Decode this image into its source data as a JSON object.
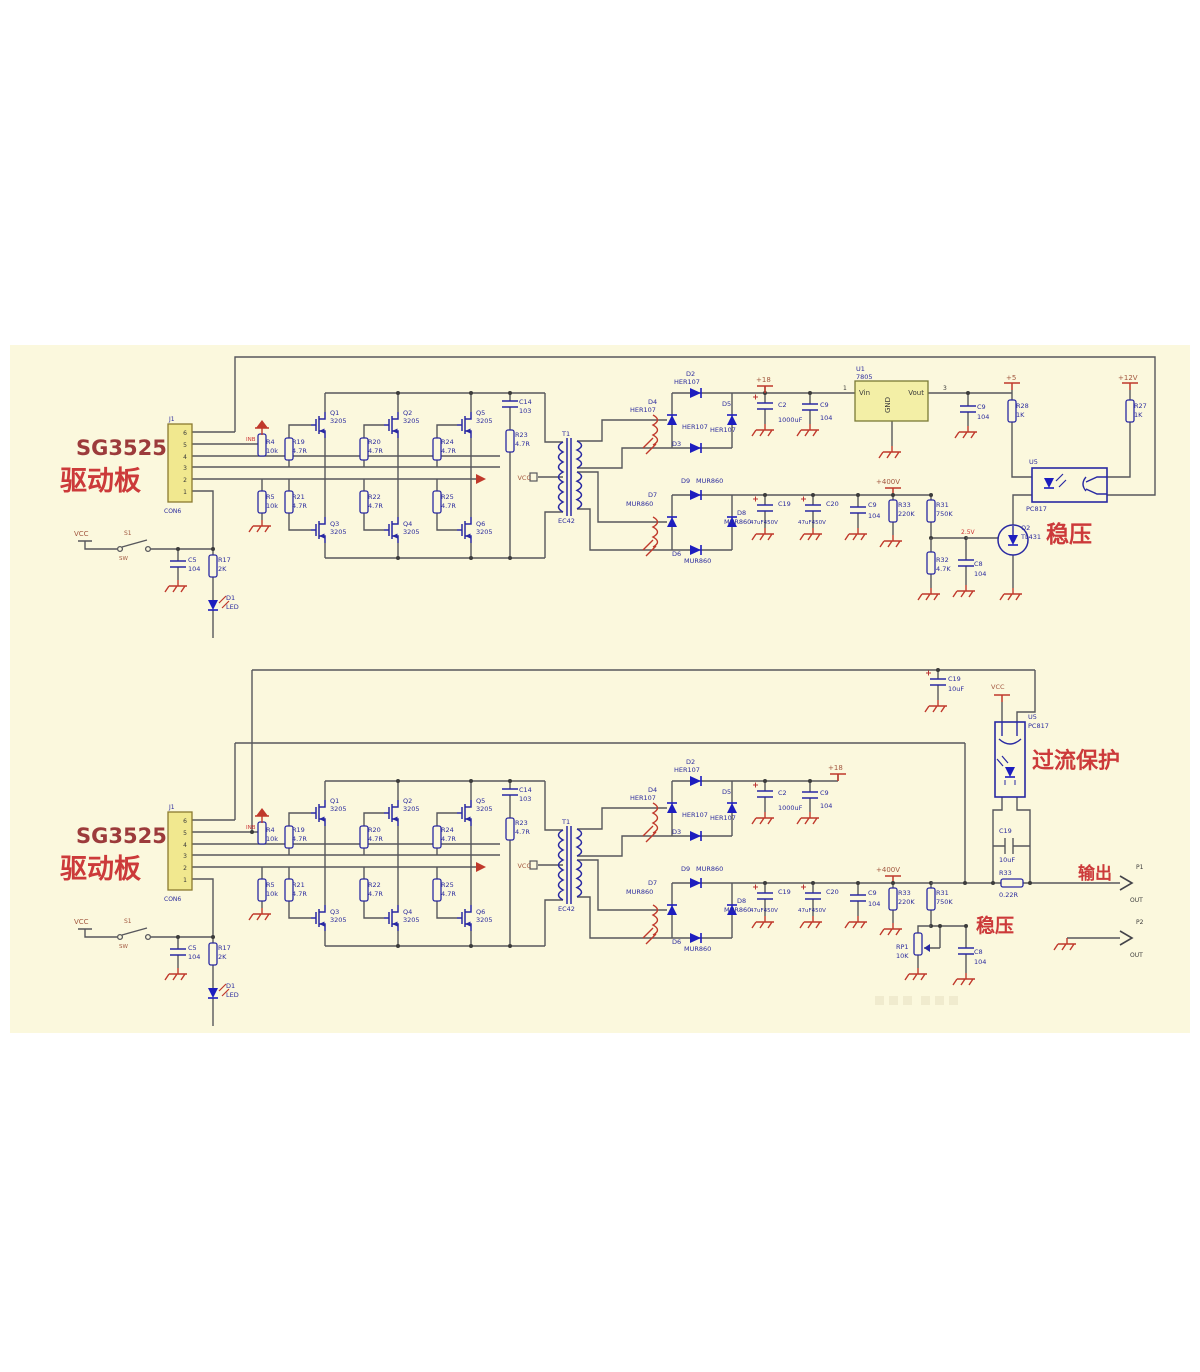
{
  "canvas": {
    "width": 1200,
    "height": 1372,
    "background": "#ffffff",
    "paper_color": "#fbf8dd",
    "paper_area": {
      "x": 10,
      "y": 345,
      "w": 1180,
      "h": 688
    }
  },
  "colors": {
    "wire": "#57575c",
    "component_blue": "#2929a3",
    "diode_fill": "#1d1dbf",
    "power_red": "#c0392b",
    "connector_yellow": "#f1e88f",
    "regulator_yellow": "#f3efa6",
    "label_blue": "#2b2b9e",
    "label_power": "#a2573f",
    "annotation_red": "#cc3a3a"
  },
  "text_styles": {
    "b": {
      "fill": "#2b2b9e",
      "size": 6.5
    },
    "p": {
      "fill": "#a2573f",
      "size": 7
    },
    "r": {
      "fill": "#cc3333",
      "size": 6
    },
    "k": {
      "fill": "#3a3a3a",
      "size": 6.5
    },
    "t1": {
      "fill": "#9c3b3b",
      "size": 21,
      "weight": "bold",
      "family": "Liberation Serif, serif"
    },
    "t2": {
      "fill": "#cc3a3a",
      "size": 27,
      "weight": "bold"
    },
    "a": {
      "fill": "#cc3a3a",
      "size": 21,
      "weight": "bold"
    }
  },
  "texts": [
    {
      "n": "board-title",
      "t": "SG3525",
      "x": 76,
      "y": 455,
      "c": "t1",
      "d": 1
    },
    {
      "n": "board-title-cn",
      "t": "驱动板",
      "x": 60,
      "y": 490,
      "c": "t2",
      "d": 1
    },
    {
      "n": "component-label",
      "t": "J1",
      "x": 169,
      "y": 421,
      "s": 6,
      "d": 1
    },
    {
      "n": "component-label",
      "t": "CON6",
      "x": 164,
      "y": 513,
      "s": 6,
      "d": 1
    },
    {
      "n": "pin-number",
      "t": "6",
      "x": 187,
      "y": 435,
      "c": "k",
      "s": 6,
      "a": "e",
      "d": 1
    },
    {
      "n": "pin-number",
      "t": "5",
      "x": 187,
      "y": 447,
      "c": "k",
      "s": 6,
      "a": "e",
      "d": 1
    },
    {
      "n": "pin-number",
      "t": "4",
      "x": 187,
      "y": 459,
      "c": "k",
      "s": 6,
      "a": "e",
      "d": 1
    },
    {
      "n": "pin-number",
      "t": "3",
      "x": 187,
      "y": 470,
      "c": "k",
      "s": 6,
      "a": "e",
      "d": 1
    },
    {
      "n": "pin-number",
      "t": "2",
      "x": 187,
      "y": 482,
      "c": "k",
      "s": 6,
      "a": "e",
      "d": 1
    },
    {
      "n": "pin-number",
      "t": "1",
      "x": 187,
      "y": 494,
      "c": "k",
      "s": 6,
      "a": "e",
      "d": 1
    },
    {
      "n": "net-label",
      "t": "INB",
      "x": 246,
      "y": 441,
      "c": "r",
      "s": 5.5,
      "d": 1
    },
    {
      "n": "net-label",
      "t": "VCC",
      "x": 74,
      "y": 536,
      "c": "p",
      "d": 1
    },
    {
      "n": "component-label",
      "t": "S1",
      "x": 124,
      "y": 535,
      "c": "p",
      "s": 6,
      "d": 1
    },
    {
      "n": "component-label",
      "t": "SW",
      "x": 119,
      "y": 560,
      "c": "p",
      "s": 5.5,
      "d": 1
    },
    {
      "n": "component-label",
      "t": "C5",
      "x": 188,
      "y": 562,
      "d": 1
    },
    {
      "n": "component-label",
      "t": "104",
      "x": 188,
      "y": 571,
      "d": 1
    },
    {
      "n": "component-label",
      "t": "R17",
      "x": 218,
      "y": 562,
      "d": 1
    },
    {
      "n": "component-label",
      "t": "2K",
      "x": 218,
      "y": 571,
      "d": 1
    },
    {
      "n": "component-label",
      "t": "D1",
      "x": 226,
      "y": 600,
      "d": 1
    },
    {
      "n": "component-label",
      "t": "LED",
      "x": 226,
      "y": 609,
      "d": 1
    },
    {
      "n": "component-label",
      "t": "R4",
      "x": 266,
      "y": 444,
      "d": 1
    },
    {
      "n": "component-label",
      "t": "10k",
      "x": 266,
      "y": 453,
      "d": 1
    },
    {
      "n": "component-label",
      "t": "R19",
      "x": 292,
      "y": 444,
      "d": 1
    },
    {
      "n": "component-label",
      "t": "4.7R",
      "x": 292,
      "y": 453,
      "d": 1
    },
    {
      "n": "component-label",
      "t": "R5",
      "x": 266,
      "y": 499,
      "d": 1
    },
    {
      "n": "component-label",
      "t": "10k",
      "x": 266,
      "y": 508,
      "d": 1
    },
    {
      "n": "component-label",
      "t": "R21",
      "x": 292,
      "y": 499,
      "d": 1
    },
    {
      "n": "component-label",
      "t": "4.7R",
      "x": 292,
      "y": 508,
      "d": 1
    },
    {
      "n": "component-label",
      "t": "Q1",
      "x": 330,
      "y": 415,
      "d": 1
    },
    {
      "n": "component-label",
      "t": "3205",
      "x": 330,
      "y": 423,
      "d": 1
    },
    {
      "n": "component-label",
      "t": "Q2",
      "x": 403,
      "y": 415,
      "d": 1
    },
    {
      "n": "component-label",
      "t": "3205",
      "x": 403,
      "y": 423,
      "d": 1
    },
    {
      "n": "component-label",
      "t": "Q5",
      "x": 476,
      "y": 415,
      "d": 1
    },
    {
      "n": "component-label",
      "t": "3205",
      "x": 476,
      "y": 423,
      "d": 1
    },
    {
      "n": "component-label",
      "t": "R20",
      "x": 368,
      "y": 444,
      "d": 1
    },
    {
      "n": "component-label",
      "t": "4.7R",
      "x": 368,
      "y": 453,
      "d": 1
    },
    {
      "n": "component-label",
      "t": "R24",
      "x": 441,
      "y": 444,
      "d": 1
    },
    {
      "n": "component-label",
      "t": "4.7R",
      "x": 441,
      "y": 453,
      "d": 1
    },
    {
      "n": "component-label",
      "t": "R22",
      "x": 368,
      "y": 499,
      "d": 1
    },
    {
      "n": "component-label",
      "t": "4.7R",
      "x": 368,
      "y": 508,
      "d": 1
    },
    {
      "n": "component-label",
      "t": "R25",
      "x": 441,
      "y": 499,
      "d": 1
    },
    {
      "n": "component-label",
      "t": "4.7R",
      "x": 441,
      "y": 508,
      "d": 1
    },
    {
      "n": "component-label",
      "t": "Q3",
      "x": 330,
      "y": 526,
      "d": 1
    },
    {
      "n": "component-label",
      "t": "3205",
      "x": 330,
      "y": 534,
      "d": 1
    },
    {
      "n": "component-label",
      "t": "Q4",
      "x": 403,
      "y": 526,
      "d": 1
    },
    {
      "n": "component-label",
      "t": "3205",
      "x": 403,
      "y": 534,
      "d": 1
    },
    {
      "n": "component-label",
      "t": "Q6",
      "x": 476,
      "y": 526,
      "d": 1
    },
    {
      "n": "component-label",
      "t": "3205",
      "x": 476,
      "y": 534,
      "d": 1
    },
    {
      "n": "component-label",
      "t": "C14",
      "x": 519,
      "y": 404,
      "d": 1
    },
    {
      "n": "component-label",
      "t": "103",
      "x": 519,
      "y": 413,
      "d": 1
    },
    {
      "n": "component-label",
      "t": "R23",
      "x": 515,
      "y": 437,
      "d": 1
    },
    {
      "n": "component-label",
      "t": "4.7R",
      "x": 515,
      "y": 446,
      "d": 1
    },
    {
      "n": "net-label",
      "t": "VCC",
      "x": 531,
      "y": 480,
      "c": "p",
      "s": 6.5,
      "a": "e",
      "d": 1
    },
    {
      "n": "component-label",
      "t": "T1",
      "x": 562,
      "y": 436,
      "d": 1
    },
    {
      "n": "component-label",
      "t": "EC42",
      "x": 558,
      "y": 523,
      "d": 1
    },
    {
      "n": "component-label",
      "t": "D2",
      "x": 686,
      "y": 376,
      "d": 1
    },
    {
      "n": "component-label",
      "t": "HER107",
      "x": 674,
      "y": 384,
      "d": 1
    },
    {
      "n": "component-label",
      "t": "D4",
      "x": 648,
      "y": 404,
      "d": 1
    },
    {
      "n": "component-label",
      "t": "HER107",
      "x": 630,
      "y": 412,
      "d": 1
    },
    {
      "n": "component-label",
      "t": "D5",
      "x": 722,
      "y": 406,
      "d": 1
    },
    {
      "n": "component-label",
      "t": "HER107",
      "x": 710,
      "y": 432,
      "d": 1
    },
    {
      "n": "component-label",
      "t": "HER107",
      "x": 682,
      "y": 429,
      "d": 1
    },
    {
      "n": "component-label",
      "t": "D3",
      "x": 672,
      "y": 446,
      "d": 1
    },
    {
      "n": "component-label",
      "t": "C2",
      "x": 778,
      "y": 407,
      "d": 1
    },
    {
      "n": "component-label",
      "t": "1000uF",
      "x": 778,
      "y": 422,
      "d": 1
    },
    {
      "n": "component-label",
      "t": "C9",
      "x": 820,
      "y": 407,
      "d": 1
    },
    {
      "n": "component-label",
      "t": "104",
      "x": 820,
      "y": 420,
      "d": 1
    },
    {
      "n": "component-label",
      "t": "D9",
      "x": 681,
      "y": 483,
      "d": 1
    },
    {
      "n": "component-label",
      "t": "MUR860",
      "x": 696,
      "y": 483,
      "d": 1
    },
    {
      "n": "component-label",
      "t": "D7",
      "x": 648,
      "y": 497,
      "d": 1
    },
    {
      "n": "component-label",
      "t": "MUR860",
      "x": 626,
      "y": 506,
      "d": 1
    },
    {
      "n": "component-label",
      "t": "D8",
      "x": 737,
      "y": 515,
      "d": 1
    },
    {
      "n": "component-label",
      "t": "MUR860",
      "x": 724,
      "y": 524,
      "d": 1
    },
    {
      "n": "component-label",
      "t": "D6",
      "x": 672,
      "y": 556,
      "d": 1
    },
    {
      "n": "component-label",
      "t": "MUR860",
      "x": 684,
      "y": 563,
      "d": 1
    },
    {
      "n": "component-label",
      "t": "C19",
      "x": 778,
      "y": 506,
      "d": 1
    },
    {
      "n": "component-label",
      "t": "47uF450V",
      "x": 750,
      "y": 524,
      "s": 5.5,
      "d": 1
    },
    {
      "n": "component-label",
      "t": "C20",
      "x": 826,
      "y": 506,
      "d": 1
    },
    {
      "n": "component-label",
      "t": "47uF450V",
      "x": 798,
      "y": 524,
      "s": 5.5,
      "d": 1
    },
    {
      "n": "component-label",
      "t": "C9",
      "x": 868,
      "y": 507,
      "d": 1
    },
    {
      "n": "component-label",
      "t": "104",
      "x": 868,
      "y": 518,
      "d": 1
    },
    {
      "n": "net-label",
      "t": "+400V",
      "x": 876,
      "y": 484,
      "c": "p",
      "d": 1
    },
    {
      "n": "component-label",
      "t": "R33",
      "x": 898,
      "y": 507,
      "d": 1
    },
    {
      "n": "component-label",
      "t": "220K",
      "x": 898,
      "y": 516,
      "d": 1
    },
    {
      "n": "component-label",
      "t": "R31",
      "x": 936,
      "y": 507,
      "d": 1
    },
    {
      "n": "component-label",
      "t": "750K",
      "x": 936,
      "y": 516,
      "d": 1
    },
    {
      "n": "component-label",
      "t": "C8",
      "x": 974,
      "y": 566,
      "d": 1
    },
    {
      "n": "component-label",
      "t": "104",
      "x": 974,
      "y": 576,
      "d": 1
    },
    {
      "n": "net-label",
      "t": "+18",
      "x": 756,
      "y": 382,
      "c": "p"
    },
    {
      "n": "component-label",
      "t": "U1",
      "x": 856,
      "y": 371
    },
    {
      "n": "component-label",
      "t": "7805",
      "x": 856,
      "y": 379
    },
    {
      "n": "ic-pin-label",
      "t": "Vin",
      "x": 859,
      "y": 395,
      "c": "k",
      "s": 7
    },
    {
      "n": "ic-pin-label",
      "t": "Vout",
      "x": 924,
      "y": 395,
      "c": "k",
      "s": 7,
      "a": "e"
    },
    {
      "n": "ic-pin-label",
      "t": "GND",
      "x": 890,
      "y": 405,
      "c": "k",
      "s": 7,
      "a": "m",
      "r": -90
    },
    {
      "n": "pin-number",
      "t": "1",
      "x": 843,
      "y": 390,
      "c": "k",
      "s": 6
    },
    {
      "n": "pin-number",
      "t": "3",
      "x": 943,
      "y": 390,
      "c": "k",
      "s": 6
    },
    {
      "n": "component-label",
      "t": "C9",
      "x": 977,
      "y": 409
    },
    {
      "n": "component-label",
      "t": "104",
      "x": 977,
      "y": 419
    },
    {
      "n": "net-label",
      "t": "+5",
      "x": 1006,
      "y": 380,
      "c": "p"
    },
    {
      "n": "component-label",
      "t": "R28",
      "x": 1016,
      "y": 408
    },
    {
      "n": "component-label",
      "t": "1K",
      "x": 1016,
      "y": 417
    },
    {
      "n": "net-label",
      "t": "+12V",
      "x": 1118,
      "y": 380,
      "c": "p"
    },
    {
      "n": "component-label",
      "t": "R27",
      "x": 1134,
      "y": 408
    },
    {
      "n": "component-label",
      "t": "1K",
      "x": 1134,
      "y": 417
    },
    {
      "n": "component-label",
      "t": "U5",
      "x": 1029,
      "y": 464
    },
    {
      "n": "component-label",
      "t": "PC817",
      "x": 1026,
      "y": 511
    },
    {
      "n": "annotation",
      "t": "稳压",
      "x": 1046,
      "y": 542,
      "c": "a",
      "s": 23
    },
    {
      "n": "component-label",
      "t": "Q2",
      "x": 1021,
      "y": 530
    },
    {
      "n": "component-label",
      "t": "TL431",
      "x": 1021,
      "y": 539
    },
    {
      "n": "net-label",
      "t": "2.5V",
      "x": 961,
      "y": 534,
      "c": "r"
    },
    {
      "n": "component-label",
      "t": "R32",
      "x": 936,
      "y": 562
    },
    {
      "n": "component-label",
      "t": "4.7K",
      "x": 936,
      "y": 571
    },
    {
      "n": "net-label",
      "t": "+18",
      "x": 828,
      "y": 770,
      "c": "p"
    },
    {
      "n": "component-label",
      "t": "C19",
      "x": 948,
      "y": 681
    },
    {
      "n": "component-label",
      "t": "10uF",
      "x": 948,
      "y": 691
    },
    {
      "n": "net-label",
      "t": "VCC",
      "x": 991,
      "y": 689,
      "c": "p",
      "s": 6.5
    },
    {
      "n": "component-label",
      "t": "U5",
      "x": 1028,
      "y": 719
    },
    {
      "n": "component-label",
      "t": "PC817",
      "x": 1028,
      "y": 728
    },
    {
      "n": "annotation",
      "t": "过流保护",
      "x": 1032,
      "y": 768,
      "c": "a",
      "s": 22
    },
    {
      "n": "component-label",
      "t": "C19",
      "x": 999,
      "y": 833
    },
    {
      "n": "component-label",
      "t": "10uF",
      "x": 999,
      "y": 862
    },
    {
      "n": "component-label",
      "t": "R33",
      "x": 999,
      "y": 875
    },
    {
      "n": "component-label",
      "t": "0.22R",
      "x": 999,
      "y": 897
    },
    {
      "n": "annotation",
      "t": "输出",
      "x": 1078,
      "y": 879,
      "c": "a",
      "s": 17
    },
    {
      "n": "component-label",
      "t": "P1",
      "x": 1136,
      "y": 869,
      "c": "k",
      "s": 6
    },
    {
      "n": "component-label",
      "t": "OUT",
      "x": 1130,
      "y": 902,
      "c": "k",
      "s": 6
    },
    {
      "n": "component-label",
      "t": "P2",
      "x": 1136,
      "y": 924,
      "c": "k",
      "s": 6
    },
    {
      "n": "component-label",
      "t": "OUT",
      "x": 1130,
      "y": 957,
      "c": "k",
      "s": 6
    },
    {
      "n": "component-label",
      "t": "RP1",
      "x": 896,
      "y": 949
    },
    {
      "n": "component-label",
      "t": "10K",
      "x": 896,
      "y": 958
    },
    {
      "n": "annotation",
      "t": "稳压",
      "x": 976,
      "y": 932,
      "c": "a",
      "s": 19
    }
  ]
}
